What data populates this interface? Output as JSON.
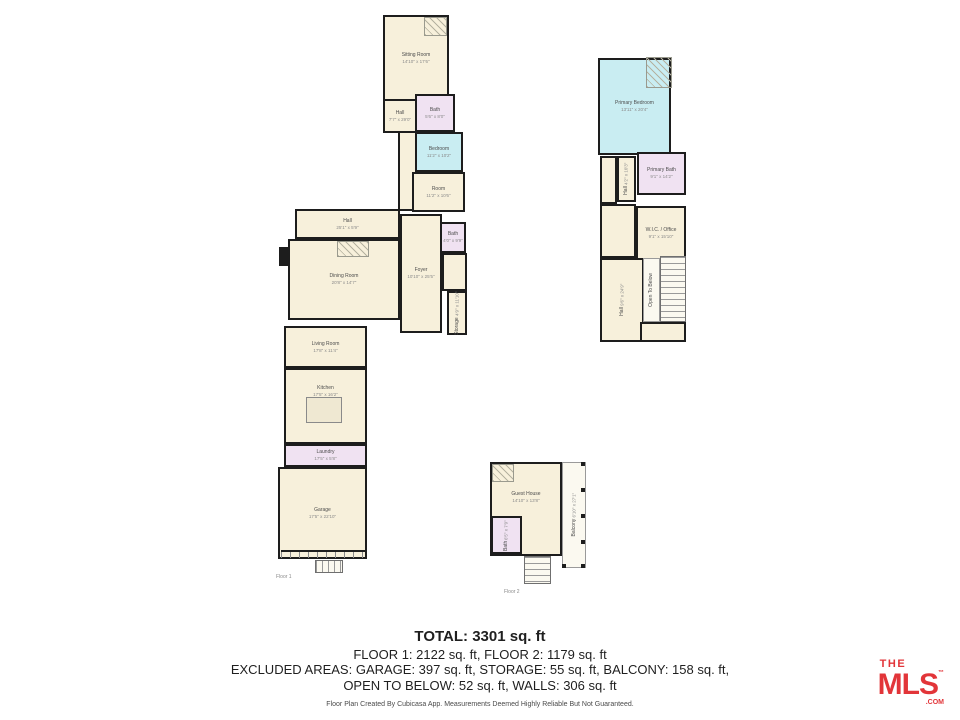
{
  "colors": {
    "wall": "#1d1d1d",
    "room_cream": "#f7f0db",
    "room_cyan": "#c9edf2",
    "room_lavender": "#f0e2f2",
    "logo_red": "#e23539"
  },
  "floor1": {
    "label": "Floor 1",
    "rooms": {
      "sitting": {
        "name": "Sitting Room",
        "dims": "14'10\" x 17'6\""
      },
      "hallUpper": {
        "name": "Hall",
        "dims": "7'7\" x 29'0\""
      },
      "bathUpper": {
        "name": "Bath",
        "dims": "5'6\" x 8'0\""
      },
      "bedroom": {
        "name": "Bedroom",
        "dims": "11'2\" x 10'2\""
      },
      "room": {
        "name": "Room",
        "dims": "11'2\" x 10'6\""
      },
      "hallMain": {
        "name": "Hall",
        "dims": "25'1\" x 5'9\""
      },
      "dining": {
        "name": "Dining Room",
        "dims": "20'8\" x 14'7\""
      },
      "foyer": {
        "name": "Foyer",
        "dims": "10'10\" x 25'5\""
      },
      "bathMid": {
        "name": "Bath",
        "dims": "4'0\" x 9'9\""
      },
      "storage": {
        "name": "Storage",
        "dims": "4'9\" x 11'10\""
      },
      "living": {
        "name": "Living Room",
        "dims": "17'8\" x 11'4\""
      },
      "kitchen": {
        "name": "Kitchen",
        "dims": "17'5\" x 16'2\""
      },
      "laundry": {
        "name": "Laundry",
        "dims": "17'5\" x 5'8\""
      },
      "garage": {
        "name": "Garage",
        "dims": "17'5\" x 22'10\""
      }
    }
  },
  "floor2": {
    "rooms": {
      "primaryBedroom": {
        "name": "Primary Bedroom",
        "dims": "13'11\" x 20'4\""
      },
      "primaryBath": {
        "name": "Primary Bath",
        "dims": "9'1\" x 14'2\""
      },
      "hallSmall": {
        "name": "Hall",
        "dims": "4'2\" x 10'3\""
      },
      "wicOffice": {
        "name": "W.I.C. / Office",
        "dims": "9'1\" x 15'10\""
      },
      "hallLower": {
        "name": "Hall",
        "dims": "9'6\" x 24'9\""
      },
      "openBelow": {
        "name": "Open To Below",
        "dims": ""
      }
    }
  },
  "guest": {
    "label": "Floor 2",
    "rooms": {
      "guestHouse": {
        "name": "Guest House",
        "dims": "14'10\" x 13'8\""
      },
      "bath": {
        "name": "Bath",
        "dims": "6'5\" x 7'9\""
      },
      "balcony": {
        "name": "Balcony",
        "dims": "6'10\" x 27'1\""
      }
    }
  },
  "summary": {
    "total": "TOTAL: 3301 sq. ft",
    "floors": "FLOOR 1: 2122 sq. ft, FLOOR 2: 1179 sq. ft",
    "excluded1": "EXCLUDED AREAS: GARAGE: 397 sq. ft, STORAGE: 55 sq. ft, BALCONY: 158 sq. ft,",
    "excluded2": "OPEN TO BELOW: 52 sq. ft, WALLS: 306 sq. ft",
    "disclaimer": "Floor Plan Created By Cubicasa App. Measurements Deemed Highly Reliable But Not Guaranteed."
  },
  "logo": {
    "the": "THE",
    "mls": "MLS",
    "tm": "™",
    "com": ".COM"
  }
}
